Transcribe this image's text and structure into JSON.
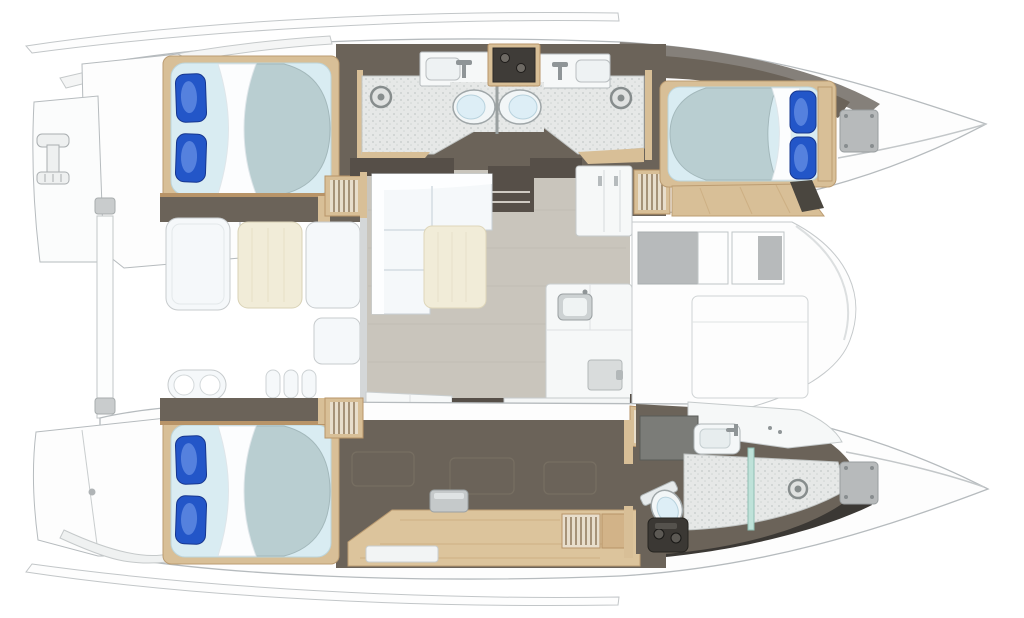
{
  "title": "Catamaran interior layout floor plan, top-down view, bows pointing right",
  "palette": {
    "hull_white": "#fdfdfd",
    "outline_gray": "#b6bbbe",
    "interior_dark": "#6b6359",
    "interior_darker": "#564f48",
    "charcoal": "#3b3834",
    "deck_band_gray": "#85807a",
    "wood_trim": "#d8bf97",
    "wood_dark": "#b89468",
    "wood_light": "#e8decc",
    "desk_wood": "#dcc49c",
    "mattress_pale": "#d9ecf2",
    "duvet_sage": "#b9ced1",
    "pillow_blue": "#2356c8",
    "pillow_highlight": "#7fa5f0",
    "salon_floor": "#c9c5bc",
    "tile_floor": "#e6e8e7",
    "cream": "#f1ecd8",
    "sofa_white": "#f5f8fa",
    "fixture_gray": "#b7babb",
    "counter_white": "#f6f8f8",
    "glass_teal": "#bfe2d9"
  },
  "vessel": {
    "kind": "sailing catamaran floor plan",
    "view": "top-down",
    "bow_direction": "right",
    "hull_count": 2
  },
  "rooms": [
    {
      "id": "port-aft-cabin",
      "label": "port aft double cabin",
      "fixtures": [
        "double-berth",
        "two-blue-pillows",
        "duvet"
      ]
    },
    {
      "id": "port-aft-head",
      "label": "port aft bathroom",
      "fixtures": [
        "sink",
        "toilet",
        "shower-drain"
      ]
    },
    {
      "id": "port-forward-head",
      "label": "port forward bathroom",
      "fixtures": [
        "sink",
        "toilet",
        "shower-drain"
      ]
    },
    {
      "id": "port-forward-cabin",
      "label": "port forward double cabin",
      "fixtures": [
        "double-berth",
        "two-blue-pillows",
        "bow-locker-hatch"
      ]
    },
    {
      "id": "salon",
      "label": "salon",
      "fixtures": [
        "l-shaped-sofa",
        "cream-lounge-cushion",
        "storage-cabinet"
      ]
    },
    {
      "id": "galley",
      "label": "galley",
      "fixtures": [
        "counter",
        "sink",
        "stove-4-burner",
        "refrigerator",
        "floor-hatch"
      ]
    },
    {
      "id": "aft-cockpit",
      "label": "aft cockpit",
      "fixtures": [
        "bench-seat",
        "dining-table",
        "seat",
        "double-stool",
        "aft-beam-cleats"
      ]
    },
    {
      "id": "forward-cockpit",
      "label": "forward cockpit lounge",
      "fixtures": [
        "bench-seats",
        "sunpad",
        "wood-step"
      ]
    },
    {
      "id": "starboard-aft-cabin",
      "label": "starboard aft double cabin",
      "fixtures": [
        "double-berth",
        "two-blue-pillows"
      ]
    },
    {
      "id": "starboard-desk-area",
      "label": "starboard desk corridor",
      "fixtures": [
        "desk",
        "seat",
        "louvered-locker"
      ]
    },
    {
      "id": "starboard-forward-bathroom",
      "label": "starboard forward bathroom",
      "fixtures": [
        "sink",
        "vanity",
        "toilet",
        "shower",
        "glass-partition",
        "shower-drain",
        "equipment-box",
        "bow-locker-hatch"
      ]
    },
    {
      "id": "swim-platforms",
      "label": "transom swim platforms",
      "fixtures": [
        "boarding-ladder",
        "transom-steps"
      ]
    }
  ],
  "counts": {
    "berths": 3,
    "toilets": 3,
    "shower_drains": 3,
    "sinks": 4,
    "companionway_stairs": 4
  }
}
